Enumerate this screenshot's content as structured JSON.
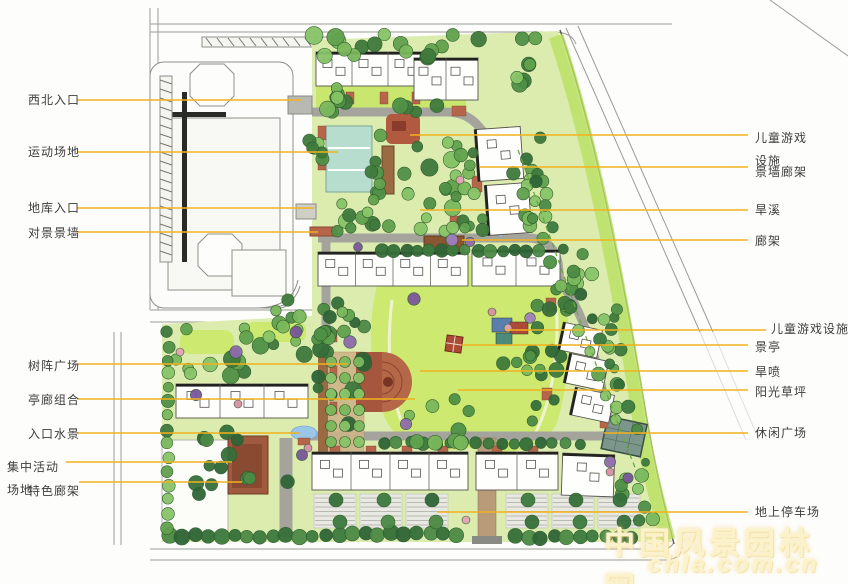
{
  "plan": {
    "type": "residential landscape master plan",
    "watermark": {
      "line1": "中国风景园林网",
      "line2": "chla.com.cn"
    },
    "colors": {
      "leader_line": "#F2B11E",
      "label_text": "#3d3d3d",
      "lawn": "#cde96f",
      "site_base": "#dcecae",
      "road": "#a4a49d",
      "court_teal": "#b7ddcf",
      "plaza_red": "#a5563c",
      "water_blue": "#9cc6e8"
    }
  },
  "labels": {
    "left": [
      {
        "text": "西北入口"
      },
      {
        "text": "运动场地"
      },
      {
        "text": "地库入口"
      },
      {
        "text": "对景景墙"
      },
      {
        "text": "树阵广场"
      },
      {
        "text": "亭廊组合"
      },
      {
        "text": "入口水景"
      },
      {
        "text": "集中活动场地"
      },
      {
        "text": "特色廊架"
      }
    ],
    "right": [
      {
        "text": "儿童游戏设施"
      },
      {
        "text": "景墙廊架"
      },
      {
        "text": "旱溪"
      },
      {
        "text": "廊架"
      },
      {
        "text": "儿童游戏设施"
      },
      {
        "text": "景亭"
      },
      {
        "text": "旱喷"
      },
      {
        "text": "阳光草坪"
      },
      {
        "text": "休闲广场"
      },
      {
        "text": "地上停车场"
      }
    ]
  }
}
